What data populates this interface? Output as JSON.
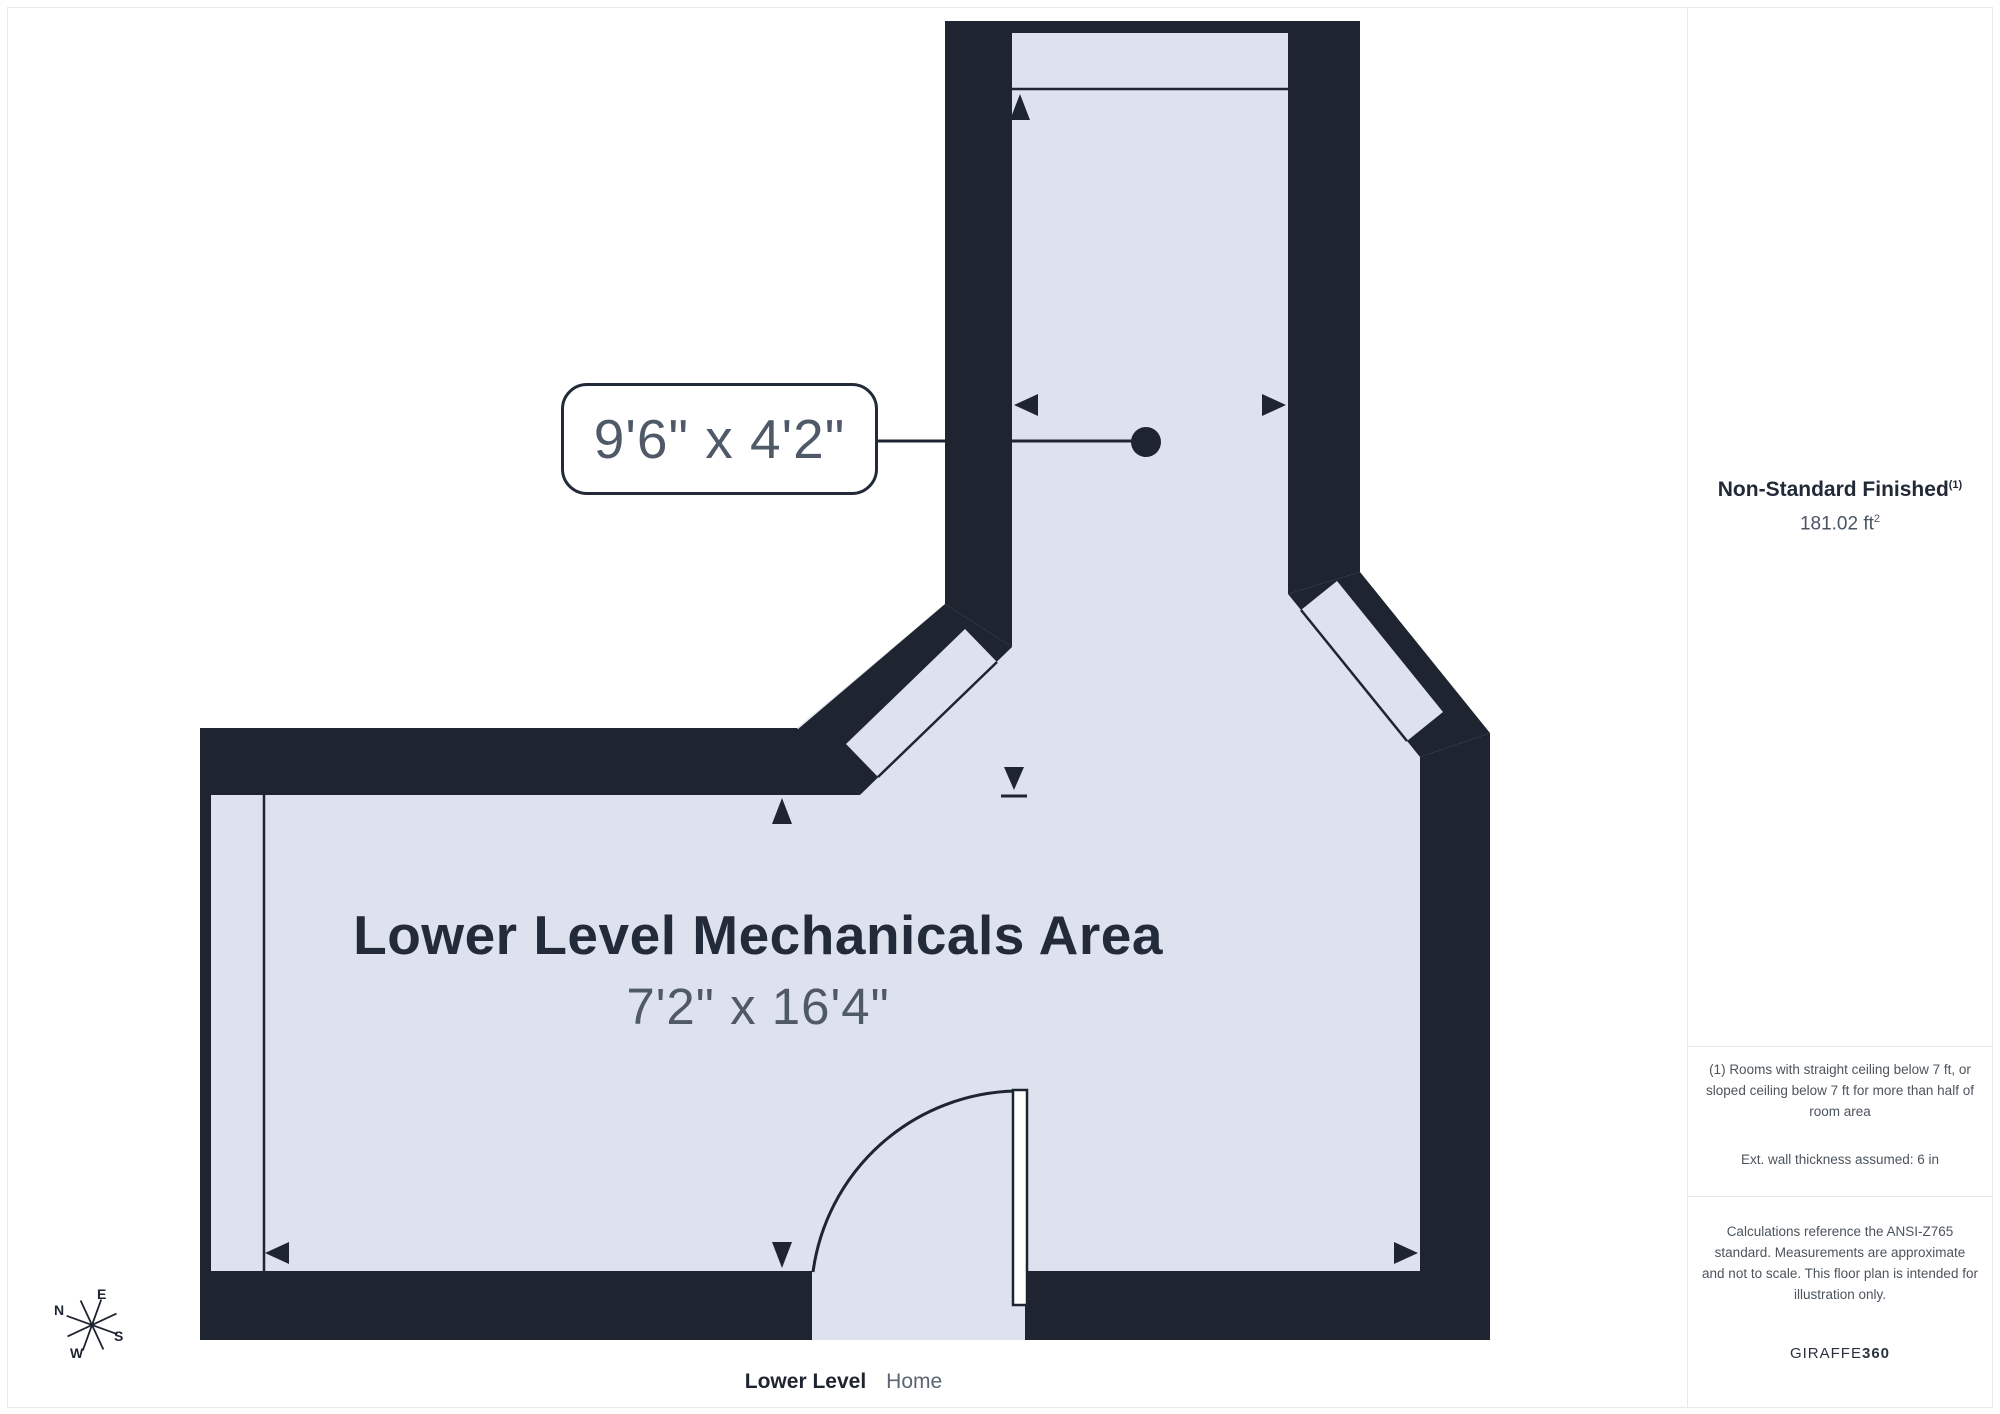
{
  "page": {
    "background": "#ffffff",
    "border_color": "#e7e9ee"
  },
  "plan": {
    "colors": {
      "wall": "#1e2430",
      "floor": "#dde2ee",
      "dim_text": "#4f5968",
      "label_text": "#232b3a"
    },
    "room": {
      "name": "Lower Level Mechanicals Area",
      "dimensions": "7'2\" x 16'4\""
    },
    "callout": {
      "text": "9'6\" x 4'2\""
    },
    "compass": {
      "n": "N",
      "e": "E",
      "s": "S",
      "w": "W"
    }
  },
  "footer": {
    "level": "Lower Level",
    "home": "Home"
  },
  "sidebar": {
    "area_title": "Non-Standard Finished",
    "area_title_sup": "(1)",
    "area_value": "181.02 ft",
    "area_value_sup": "2",
    "footnote_rooms": "(1) Rooms with straight ceiling below 7 ft, or sloped ceiling below 7 ft for more than half of room area",
    "footnote_wall": "Ext. wall thickness assumed: 6 in",
    "disclaimer": "Calculations reference the ANSI-Z765 standard. Measurements are approximate and not to scale. This floor plan is intended for illustration only.",
    "brand_regular": "GIRAFFE",
    "brand_bold": "360"
  }
}
